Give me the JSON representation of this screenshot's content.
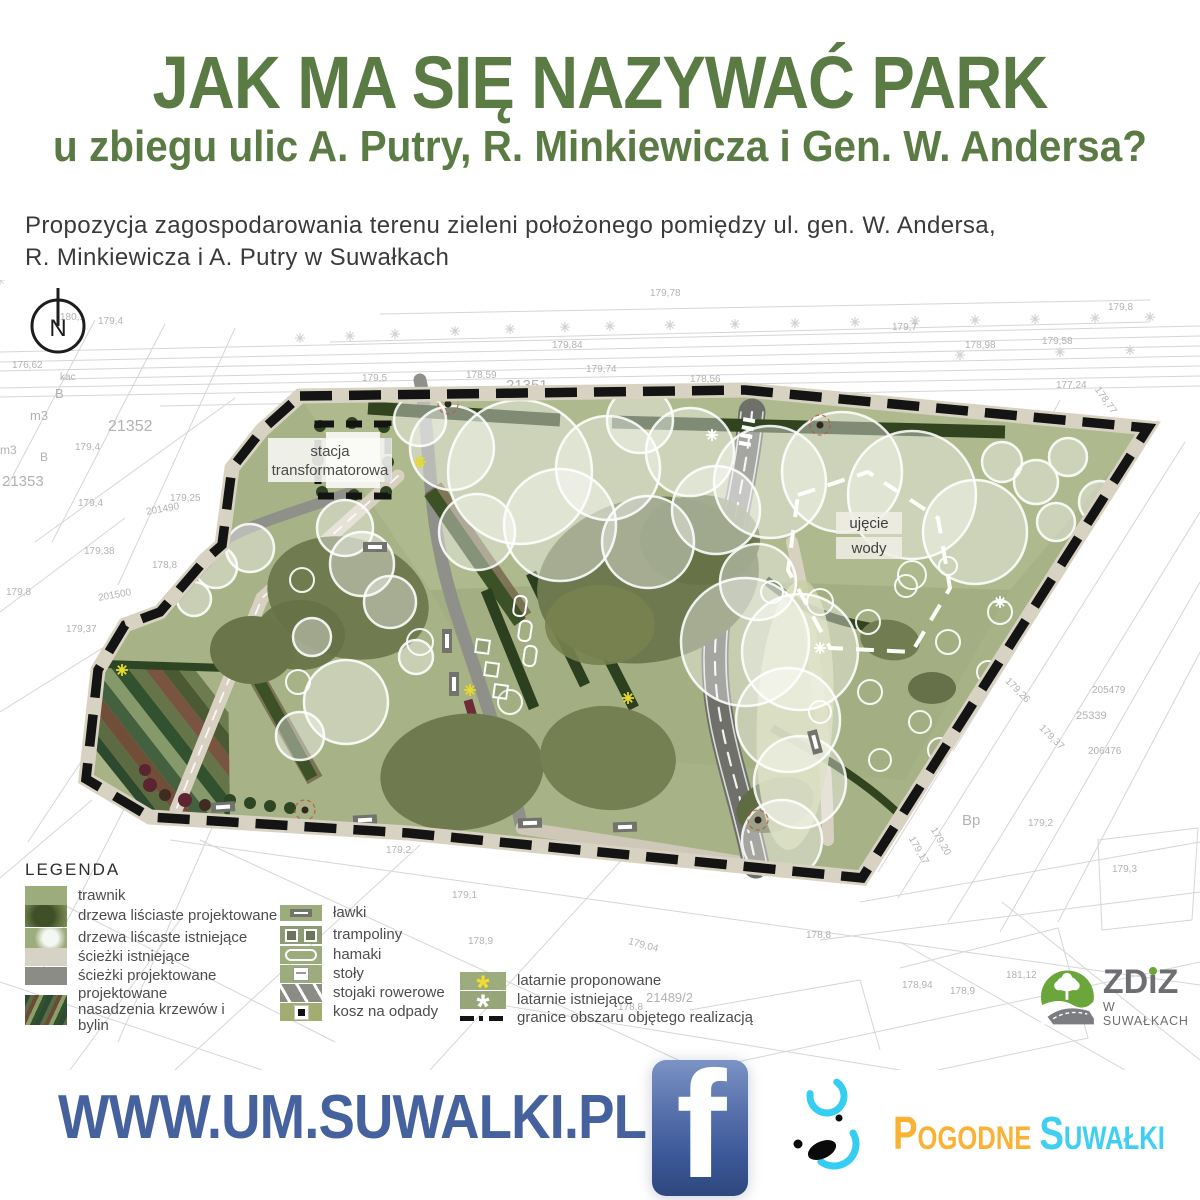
{
  "header": {
    "title": "JAK MA SIĘ NAZYWAĆ PARK",
    "subtitle": "u zbiegu ulic A. Putry, R. Minkiewicza i Gen. W. Andersa?"
  },
  "description": {
    "line1": "Propozycja zagospodarowania terenu zieleni położonego pomiędzy ul. gen. W. Andersa,",
    "line2": "R. Minkiewicza i A. Putry w Suwałkach"
  },
  "map": {
    "compass_label": "N",
    "labels": {
      "stacja_line1": "stacja",
      "stacja_line2": "transformatorowa",
      "ujecie_line1": "ujęcie",
      "ujecie_line2": "wody"
    },
    "cadastral_labels": [
      {
        "t": "21352",
        "x": 108,
        "y": 138,
        "s": 16,
        "r": 0
      },
      {
        "t": "m3",
        "x": 30,
        "y": 128,
        "s": 13,
        "r": 0
      },
      {
        "t": "B",
        "x": 55,
        "y": 106,
        "s": 13,
        "r": 0
      },
      {
        "t": "21353",
        "x": 2,
        "y": 193,
        "s": 15,
        "r": 0
      },
      {
        "t": "m3",
        "x": 0,
        "y": 163,
        "s": 12,
        "r": 0
      },
      {
        "t": "B",
        "x": 40,
        "y": 170,
        "s": 12,
        "r": 0
      },
      {
        "t": "179,4",
        "x": 75,
        "y": 162,
        "s": 10,
        "r": 0
      },
      {
        "t": "179,4",
        "x": 78,
        "y": 218,
        "s": 10,
        "r": 0
      },
      {
        "t": "179,25",
        "x": 170,
        "y": 213,
        "s": 10,
        "r": 0
      },
      {
        "t": "201490",
        "x": 146,
        "y": 224,
        "s": 10,
        "r": -10
      },
      {
        "t": "201500",
        "x": 98,
        "y": 310,
        "s": 10,
        "r": -10
      },
      {
        "t": "179,38",
        "x": 84,
        "y": 266,
        "s": 10,
        "r": 0
      },
      {
        "t": "178,8",
        "x": 152,
        "y": 280,
        "s": 10,
        "r": 0
      },
      {
        "t": "179,37",
        "x": 66,
        "y": 344,
        "s": 10,
        "r": 0
      },
      {
        "t": "179,8",
        "x": 6,
        "y": 307,
        "s": 10,
        "r": 0
      },
      {
        "t": "176,62",
        "x": 12,
        "y": 80,
        "s": 10,
        "r": 0
      },
      {
        "t": "kac",
        "x": 60,
        "y": 92,
        "s": 10,
        "r": 0
      },
      {
        "t": "179,5",
        "x": 362,
        "y": 93,
        "s": 10,
        "r": 0
      },
      {
        "t": "178,59",
        "x": 466,
        "y": 90,
        "s": 10,
        "r": 0
      },
      {
        "t": "21351",
        "x": 506,
        "y": 97,
        "s": 15,
        "r": 0
      },
      {
        "t": "dr",
        "x": 572,
        "y": 104,
        "s": 13,
        "r": 0
      },
      {
        "t": "dr",
        "x": 622,
        "y": 107,
        "s": 13,
        "r": 0
      },
      {
        "t": "179,74",
        "x": 586,
        "y": 84,
        "s": 10,
        "r": 0
      },
      {
        "t": "178,56",
        "x": 690,
        "y": 94,
        "s": 10,
        "r": 0
      },
      {
        "t": "179,84",
        "x": 552,
        "y": 60,
        "s": 10,
        "r": 0
      },
      {
        "t": "179,58",
        "x": 1042,
        "y": 56,
        "s": 10,
        "r": 0
      },
      {
        "t": "179,78",
        "x": 650,
        "y": 8,
        "s": 10,
        "r": 0
      },
      {
        "t": "179,7",
        "x": 892,
        "y": 42,
        "s": 10,
        "r": 0
      },
      {
        "t": "178,98",
        "x": 965,
        "y": 60,
        "s": 10,
        "r": 0
      },
      {
        "t": "179,8",
        "x": 1108,
        "y": 22,
        "s": 10,
        "r": 0
      },
      {
        "t": "178,77",
        "x": 1090,
        "y": 115,
        "s": 10,
        "r": 55
      },
      {
        "t": "177,24",
        "x": 1056,
        "y": 100,
        "s": 10,
        "r": 0
      },
      {
        "t": "kp.",
        "x": 985,
        "y": 372,
        "s": 10,
        "r": 0
      },
      {
        "t": "179,26",
        "x": 1002,
        "y": 405,
        "s": 10,
        "r": 45
      },
      {
        "t": "179,37",
        "x": 1036,
        "y": 452,
        "s": 10,
        "r": 45
      },
      {
        "t": "Bp",
        "x": 962,
        "y": 532,
        "s": 15,
        "r": 0
      },
      {
        "t": "179,2",
        "x": 1028,
        "y": 538,
        "s": 10,
        "r": 0
      },
      {
        "t": "179,17",
        "x": 903,
        "y": 565,
        "s": 10,
        "r": 60
      },
      {
        "t": "179,20",
        "x": 925,
        "y": 556,
        "s": 10,
        "r": 60
      },
      {
        "t": "25339",
        "x": 1076,
        "y": 430,
        "s": 11,
        "r": 0
      },
      {
        "t": "206476",
        "x": 1088,
        "y": 466,
        "s": 10,
        "r": 0
      },
      {
        "t": "205479",
        "x": 1092,
        "y": 405,
        "s": 10,
        "r": 0
      },
      {
        "t": "181,12",
        "x": 1006,
        "y": 690,
        "s": 10,
        "r": 0
      },
      {
        "t": "178,94",
        "x": 902,
        "y": 700,
        "s": 10,
        "r": 0
      },
      {
        "t": "21489/2",
        "x": 646,
        "y": 710,
        "s": 13,
        "r": 0
      },
      {
        "t": "178,8",
        "x": 618,
        "y": 722,
        "s": 10,
        "r": 0
      },
      {
        "t": "179,04",
        "x": 628,
        "y": 660,
        "s": 10,
        "r": 15
      },
      {
        "t": "178,9",
        "x": 950,
        "y": 706,
        "s": 10,
        "r": 0
      },
      {
        "t": "179,2",
        "x": 386,
        "y": 565,
        "s": 10,
        "r": 0
      },
      {
        "t": "178,8",
        "x": 806,
        "y": 650,
        "s": 10,
        "r": 0
      },
      {
        "t": "179,1",
        "x": 452,
        "y": 610,
        "s": 10,
        "r": 0
      },
      {
        "t": "178,9",
        "x": 468,
        "y": 656,
        "s": 10,
        "r": 0
      },
      {
        "t": "179,3",
        "x": 1112,
        "y": 584,
        "s": 10,
        "r": 0
      },
      {
        "t": "180,1",
        "x": 60,
        "y": 32,
        "s": 10,
        "r": 0
      },
      {
        "t": "179,4",
        "x": 98,
        "y": 36,
        "s": 10,
        "r": 0
      }
    ]
  },
  "legend": {
    "title": "LEGENDA",
    "col1": [
      {
        "icon": "lawn-swatch",
        "label": "trawnik"
      },
      {
        "icon": "trees-proposed-swatch",
        "label": "drzewa liściaste projektowane"
      },
      {
        "icon": "trees-existing-swatch",
        "label": "drzewa liścaste istniejące"
      },
      {
        "icon": "paths-existing-swatch",
        "label": "ścieżki istniejące"
      },
      {
        "icon": "paths-proposed-swatch",
        "label": "ścieżki projektowane"
      },
      {
        "icon": "plantings-swatch",
        "label": "projektowane nasadzenia krzewów i bylin"
      }
    ],
    "col2": [
      {
        "icon": "bench-icon",
        "label": "ławki"
      },
      {
        "icon": "trampoline-icon",
        "label": "trampoliny"
      },
      {
        "icon": "hammock-icon",
        "label": "hamaki"
      },
      {
        "icon": "table-icon",
        "label": "stoły"
      },
      {
        "icon": "bike-rack-icon",
        "label": "stojaki rowerowe"
      },
      {
        "icon": "trash-bin-icon",
        "label": "kosz na odpady"
      }
    ],
    "col3": [
      {
        "icon": "lamp-proposed-icon",
        "label": "latarnie proponowane"
      },
      {
        "icon": "lamp-existing-icon",
        "label": "latarnie istniejące"
      },
      {
        "icon": "boundary-line-icon",
        "label": "granice obszaru objętego realizacją"
      }
    ]
  },
  "footer": {
    "url": "WWW.UM.SUWALKI.PL"
  },
  "logos": {
    "facebook_letter": "f",
    "pogodne": {
      "word1": "Pogodne",
      "word2": "Suwałki"
    },
    "zdiz": {
      "name": "ZDiZ",
      "subtitle": "W SUWAŁKACH"
    }
  },
  "colors": {
    "title_green": "#5a7b44",
    "text_dark": "#3a3a3a",
    "url_navy": "#45619e",
    "facebook_blue": "#3b5998",
    "pogodne_orange": "#f9b233",
    "pogodne_cyan": "#40cff2",
    "zdiz_gray": "#6d6e71",
    "zdiz_green": "#6aa63a",
    "lawn_green": "#a7b286",
    "canopy_olive": "#6e7950",
    "hedge_dark": "#2c3f1e",
    "path_light": "#d8d1c1",
    "road_gray": "#6f706a",
    "boundary_black": "#141414"
  }
}
